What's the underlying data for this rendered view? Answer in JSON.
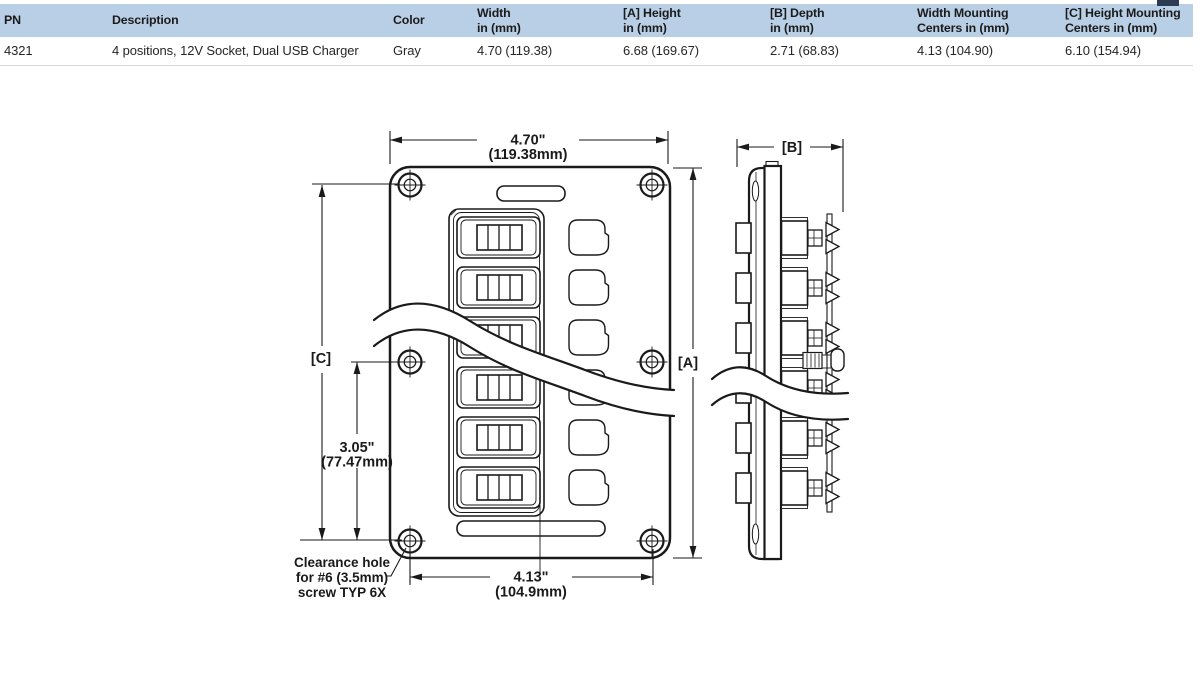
{
  "table": {
    "columns": [
      {
        "line1": "PN",
        "line2": ""
      },
      {
        "line1": "Description",
        "line2": ""
      },
      {
        "line1": "Color",
        "line2": ""
      },
      {
        "line1": "Width",
        "line2": "in (mm)"
      },
      {
        "line1": "[A] Height",
        "line2": "in (mm)"
      },
      {
        "line1": "[B] Depth",
        "line2": "in (mm)"
      },
      {
        "line1": "Width Mounting",
        "line2": "Centers in (mm)"
      },
      {
        "line1": "[C] Height Mounting",
        "line2": "Centers in (mm)"
      }
    ],
    "row": {
      "pn": "4321",
      "description": "4 positions, 12V Socket, Dual USB Charger",
      "color": "Gray",
      "width": "4.70 (119.38)",
      "height": "6.68 (169.67)",
      "depth": "2.71 (68.83)",
      "width_mounting_centers": "4.13 (104.90)",
      "height_mounting_centers": "6.10 (154.94)"
    }
  },
  "drawing": {
    "front_view": {
      "width_in": "4.70\"",
      "width_mm": "(119.38mm)",
      "height_ref": "[A]",
      "mount_height_ref": "[C]",
      "mount_height_in": "3.05\"",
      "mount_height_mm": "(77.47mm)",
      "mount_width_in": "4.13\"",
      "mount_width_mm": "(104.9mm)",
      "note_line1": "Clearance hole",
      "note_line2": "for #6 (3.5mm)",
      "note_line3": "screw TYP 6X"
    },
    "side_view": {
      "depth_ref": "[B]"
    }
  },
  "colors": {
    "table_header_bg": "#b9cfe6",
    "drawing_line": "#1a1a1a"
  }
}
